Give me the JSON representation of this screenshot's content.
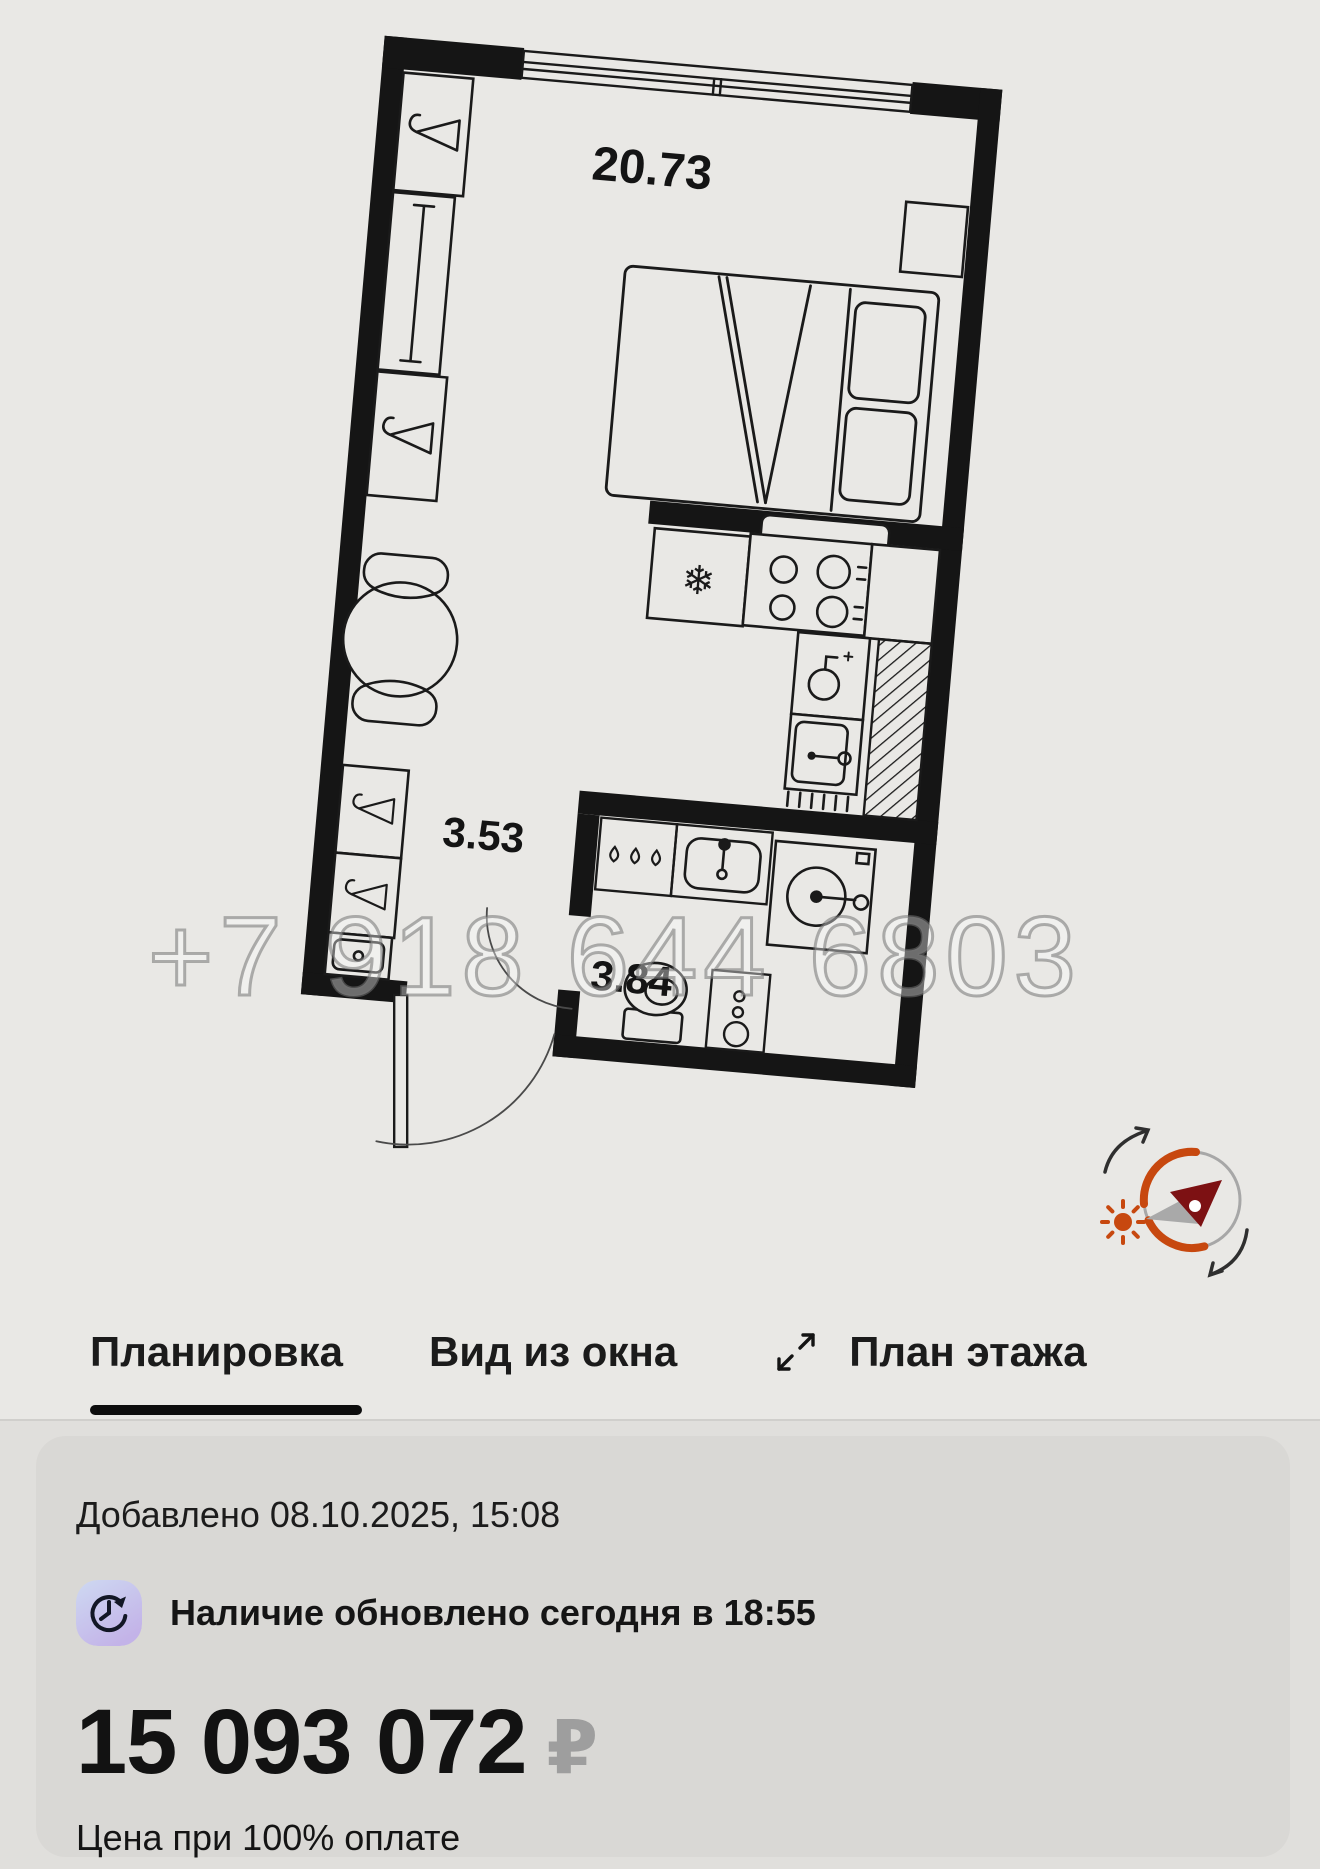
{
  "plan": {
    "labels": {
      "main": "20.73",
      "hall": "3.53",
      "bath": "3.84"
    },
    "watermark": "+7 918 644 6803",
    "line_color": "#1a1a1a",
    "wall_color": "#151515",
    "compass": {
      "arc_color": "#c7480f",
      "sun_color": "#c7480f",
      "needle_red": "#7d1113",
      "needle_gray": "#a9a9a9",
      "ring_color": "#a7a7a7",
      "arrow_color": "#2f2f2f"
    }
  },
  "tabs": [
    {
      "label": "Планировка",
      "active": true
    },
    {
      "label": "Вид из окна",
      "active": false
    },
    {
      "label": "План этажа",
      "active": false
    }
  ],
  "card": {
    "added": "Добавлено 08.10.2025, 15:08",
    "availability": "Наличие обновлено сегодня в 18:55",
    "price": "15 093 072",
    "currency": "₽",
    "note": "Цена при 100% оплате"
  },
  "colors": {
    "background": "#e9e8e5",
    "sheet_background": "#e0dfdc",
    "card_background": "#d9d8d5",
    "active_tab_underline": "#0d0d0d",
    "currency_gray": "#9e9e9e",
    "clock_badge_gradient_start": "#ced9f2",
    "clock_badge_gradient_end": "#c3b3e8"
  }
}
